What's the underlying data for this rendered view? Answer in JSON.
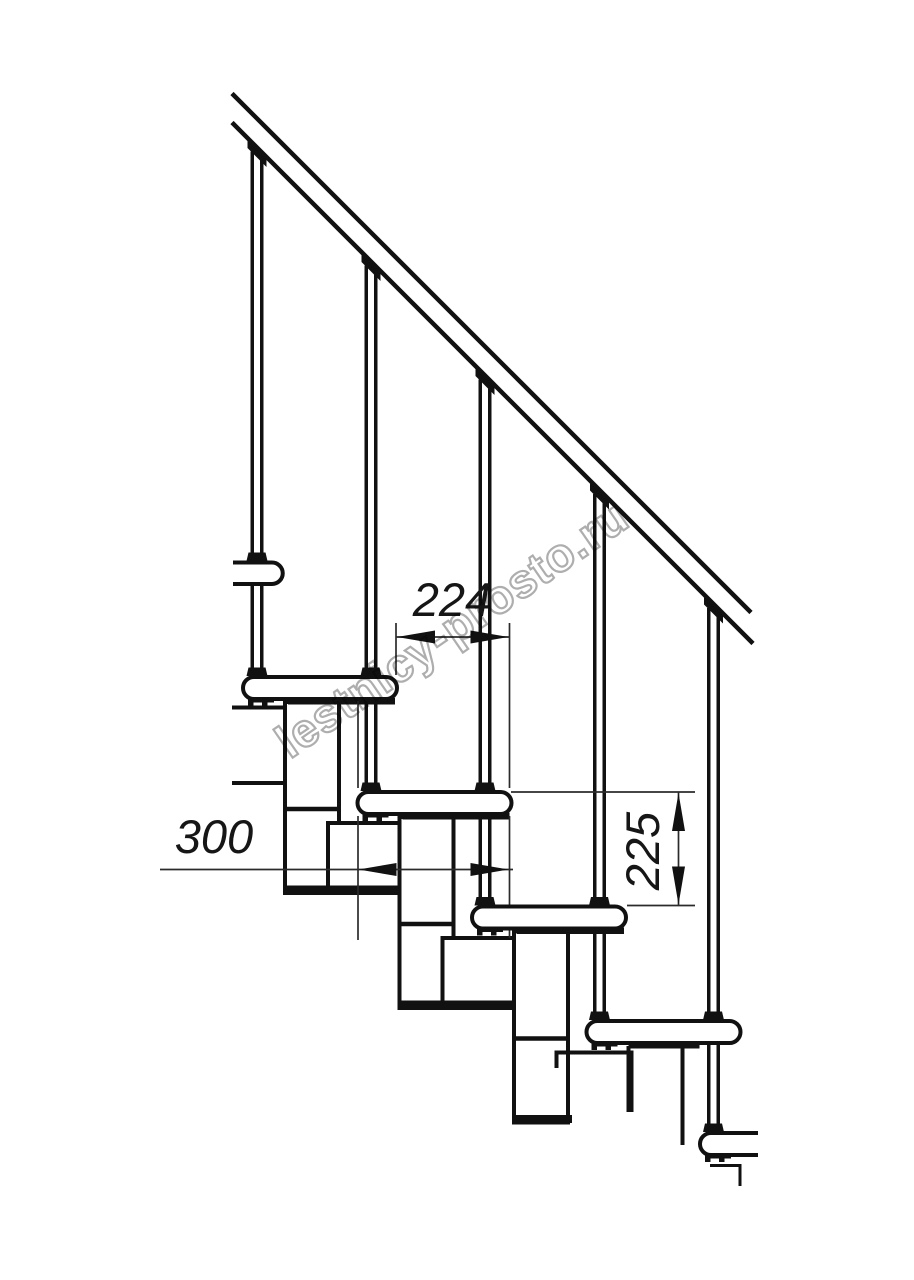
{
  "watermark": {
    "text": "lestnicy-prosto.ru"
  },
  "dimensions": {
    "going_mm": "224",
    "tread_depth_mm": "300",
    "rise_mm": "225"
  },
  "diagram": {
    "canvas": {
      "width": 914,
      "height": 1280,
      "background": "#ffffff"
    },
    "style": {
      "line": "#111111",
      "thin": "#2b2b2b",
      "fill": "#ffffff"
    },
    "shapes": [
      {
        "t": "line",
        "name": "upper-floor-edge-line",
        "x1": 232,
        "y1": 707.5,
        "x2": 287,
        "y2": 707.5,
        "w": 4
      },
      {
        "t": "line",
        "name": "upper-floor-edge-line",
        "x1": 232,
        "y1": 783,
        "x2": 287,
        "y2": 783,
        "w": 4
      },
      {
        "t": "line",
        "name": "baluster-1-left-line",
        "x1": 252.25,
        "y1": 151.5,
        "x2": 252.25,
        "y2": 676,
        "w": 3.5
      },
      {
        "t": "line",
        "name": "baluster-1-right-line",
        "x1": 261.75,
        "y1": 151.5,
        "x2": 261.75,
        "y2": 676,
        "w": 3.5
      },
      {
        "t": "line",
        "name": "baluster-2-left-line",
        "x1": 366.25,
        "y1": 265.5,
        "x2": 366.25,
        "y2": 791,
        "w": 3.5
      },
      {
        "t": "line",
        "name": "baluster-2-right-line",
        "x1": 375.75,
        "y1": 265.5,
        "x2": 375.75,
        "y2": 791,
        "w": 3.5
      },
      {
        "t": "line",
        "name": "baluster-3-left-line",
        "x1": 480.25,
        "y1": 379.5,
        "x2": 480.25,
        "y2": 905,
        "w": 3.5
      },
      {
        "t": "line",
        "name": "baluster-3-right-line",
        "x1": 489.75,
        "y1": 379.5,
        "x2": 489.75,
        "y2": 905,
        "w": 3.5
      },
      {
        "t": "line",
        "name": "baluster-4-left-line",
        "x1": 594.75,
        "y1": 494,
        "x2": 594.75,
        "y2": 1020,
        "w": 3.5
      },
      {
        "t": "line",
        "name": "baluster-4-right-line",
        "x1": 604.25,
        "y1": 494,
        "x2": 604.25,
        "y2": 1020,
        "w": 3.5
      },
      {
        "t": "line",
        "name": "baluster-5-left-line",
        "x1": 708.75,
        "y1": 608,
        "x2": 708.75,
        "y2": 1132,
        "w": 3.5
      },
      {
        "t": "line",
        "name": "baluster-5-right-line",
        "x1": 718.25,
        "y1": 608,
        "x2": 718.25,
        "y2": 1132,
        "w": 3.5
      },
      {
        "t": "poly",
        "name": "rail-connector",
        "pts": "247.5,139 266.5,158 266.5,167 247.5,148"
      },
      {
        "t": "poly",
        "name": "rail-connector",
        "pts": "361.5,253 380.5,272 380.5,281 361.5,262"
      },
      {
        "t": "poly",
        "name": "rail-connector",
        "pts": "475.5,367 494.5,386 494.5,395 475.5,376"
      },
      {
        "t": "poly",
        "name": "rail-connector",
        "pts": "590,481.5 609,500.5 609,509.5 590,490.5"
      },
      {
        "t": "poly",
        "name": "rail-connector",
        "pts": "704,595.5 723,614.5 723,623.5 704,604.5"
      },
      {
        "t": "rect",
        "name": "module-stem",
        "x": 285,
        "y": 702,
        "wd": 54,
        "h": 191,
        "sw": 4
      },
      {
        "t": "rect",
        "name": "module-box",
        "x": 328,
        "y": 823,
        "wd": 75,
        "h": 70,
        "sw": 4
      },
      {
        "t": "line",
        "name": "module-joint-line",
        "x1": 285,
        "y1": 809,
        "x2": 339,
        "y2": 809,
        "w": 4.5
      },
      {
        "t": "rect",
        "name": "module-base-plate",
        "x": 283,
        "y": 885.5,
        "wd": 122,
        "h": 8,
        "f": "#111111",
        "sw": 0
      },
      {
        "t": "rect",
        "name": "tread-mount-plate",
        "x": 288,
        "y": 698,
        "wd": 107,
        "h": 6.5,
        "f": "#111111",
        "sw": 0
      },
      {
        "t": "path",
        "name": "tread-bracket",
        "d": "M248,698 h26 v4.5 h-6.5 v3.5 h-5.5 v-3.5 h-8.5 v3.5 h-5.5 z",
        "f": "#111111",
        "sw": 0
      },
      {
        "t": "rect",
        "name": "module-stem",
        "x": 399.5,
        "y": 817,
        "wd": 54,
        "h": 191,
        "sw": 4
      },
      {
        "t": "rect",
        "name": "module-box",
        "x": 442.5,
        "y": 938,
        "wd": 75,
        "h": 70,
        "sw": 4
      },
      {
        "t": "line",
        "name": "module-joint-line",
        "x1": 399.5,
        "y1": 924,
        "x2": 453.5,
        "y2": 924,
        "w": 4.5
      },
      {
        "t": "rect",
        "name": "module-base-plate",
        "x": 397.5,
        "y": 1000.5,
        "wd": 122,
        "h": 8,
        "f": "#111111",
        "sw": 0
      },
      {
        "t": "rect",
        "name": "tread-mount-plate",
        "x": 402.5,
        "y": 813,
        "wd": 107,
        "h": 6.5,
        "f": "#111111",
        "sw": 0
      },
      {
        "t": "path",
        "name": "tread-bracket",
        "d": "M362.5,813 h26 v4.5 h-6.5 v3.5 h-5.5 v-3.5 h-8.5 v3.5 h-5.5 z",
        "f": "#111111",
        "sw": 0
      },
      {
        "t": "rect",
        "name": "module-stem",
        "x": 514,
        "y": 931.5,
        "wd": 54,
        "h": 191,
        "sw": 4
      },
      {
        "t": "path",
        "name": "module-box-partial",
        "d": "M556.5,1068 L556.5,1052.5 L631.5,1052.5 L631.5,1112",
        "f": "none",
        "sw": 4
      },
      {
        "t": "line",
        "name": "module-joint-line",
        "x1": 514,
        "y1": 1038.5,
        "x2": 568,
        "y2": 1038.5,
        "w": 4.5
      },
      {
        "t": "rect",
        "name": "module-base-plate",
        "x": 512,
        "y": 1115,
        "wd": 60,
        "h": 8,
        "f": "#111111",
        "sw": 0
      },
      {
        "t": "rect",
        "name": "tread-mount-plate",
        "x": 517,
        "y": 927.5,
        "wd": 107,
        "h": 6.5,
        "f": "#111111",
        "sw": 0
      },
      {
        "t": "path",
        "name": "tread-bracket",
        "d": "M477,927.5 h26 v4.5 h-6.5 v3.5 h-5.5 v-3.5 h-8.5 v3.5 h-5.5 z",
        "f": "#111111",
        "sw": 0
      },
      {
        "t": "line",
        "name": "module-stem-partial-edge",
        "x1": 628.5,
        "y1": 1046,
        "x2": 628.5,
        "y2": 1112,
        "w": 4
      },
      {
        "t": "line",
        "name": "module-stem-partial-edge",
        "x1": 682.5,
        "y1": 1046,
        "x2": 682.5,
        "y2": 1145,
        "w": 4
      },
      {
        "t": "rect",
        "name": "tread-mount-plate",
        "x": 628.5,
        "y": 1042,
        "wd": 71,
        "h": 6.5,
        "f": "#111111",
        "sw": 0
      },
      {
        "t": "path",
        "name": "tread-bracket",
        "d": "M591.5,1042 h26 v4.5 h-6.5 v3.5 h-5.5 v-3.5 h-8.5 v3.5 h-5.5 z",
        "f": "#111111",
        "sw": 0
      },
      {
        "t": "line",
        "name": "extension-line",
        "x1": 396,
        "y1": 623,
        "x2": 396,
        "y2": 675,
        "w": 1.7,
        "c": "#2b2b2b"
      },
      {
        "t": "line",
        "name": "extension-line",
        "x1": 509.5,
        "y1": 623,
        "x2": 509.5,
        "y2": 788,
        "w": 1.7,
        "c": "#2b2b2b"
      },
      {
        "t": "line",
        "name": "extension-line",
        "x1": 509.5,
        "y1": 816,
        "x2": 509.5,
        "y2": 938,
        "w": 1.7,
        "c": "#2b2b2b"
      },
      {
        "t": "line",
        "name": "extension-line",
        "x1": 358,
        "y1": 700,
        "x2": 358,
        "y2": 788,
        "w": 1.7,
        "c": "#2b2b2b"
      },
      {
        "t": "line",
        "name": "extension-line",
        "x1": 358,
        "y1": 816,
        "x2": 358,
        "y2": 940,
        "w": 1.7,
        "c": "#2b2b2b"
      },
      {
        "t": "line",
        "name": "extension-line",
        "x1": 511,
        "y1": 792,
        "x2": 695,
        "y2": 792,
        "w": 1.7,
        "c": "#2b2b2b"
      },
      {
        "t": "line",
        "name": "extension-line",
        "x1": 627,
        "y1": 905.5,
        "x2": 695,
        "y2": 905.5,
        "w": 1.7,
        "c": "#2b2b2b"
      },
      {
        "t": "line",
        "name": "dimension-line-going",
        "x1": 396,
        "y1": 637,
        "x2": 509.5,
        "y2": 637,
        "w": 1.7,
        "c": "#2b2b2b"
      },
      {
        "t": "line",
        "name": "dimension-line-tread-depth",
        "x1": 160,
        "y1": 869.5,
        "x2": 513,
        "y2": 869.5,
        "w": 1.7,
        "c": "#2b2b2b"
      },
      {
        "t": "line",
        "name": "dimension-line-rise",
        "x1": 678.5,
        "y1": 792,
        "x2": 678.5,
        "y2": 905.5,
        "w": 1.7,
        "c": "#2b2b2b"
      },
      {
        "t": "path",
        "name": "tread-fragment-upper",
        "d": "M233,562.5 H272 A10.75,10.75 0 0 1 272,584 H233",
        "f": "#ffffff",
        "sw": 4
      },
      {
        "t": "rect",
        "name": "tread",
        "x": 243,
        "y": 677,
        "wd": 154,
        "h": 22,
        "rx": 11,
        "sw": 4
      },
      {
        "t": "rect",
        "name": "tread",
        "x": 357.5,
        "y": 792,
        "wd": 154,
        "h": 22,
        "rx": 11,
        "sw": 4
      },
      {
        "t": "rect",
        "name": "tread",
        "x": 472,
        "y": 906.5,
        "wd": 154,
        "h": 22,
        "rx": 11,
        "sw": 4
      },
      {
        "t": "rect",
        "name": "tread",
        "x": 586.5,
        "y": 1021,
        "wd": 154,
        "h": 22,
        "rx": 11,
        "sw": 4
      },
      {
        "t": "path",
        "name": "tread-fragment-lower",
        "d": "M758,1155 H711 A11,11 0 0 1 711,1133 H758",
        "f": "#ffffff",
        "sw": 4
      },
      {
        "t": "poly",
        "name": "baluster-clamp",
        "pts": "246.5,561 248.5,552.5 265.5,552.5 267.5,561"
      },
      {
        "t": "poly",
        "name": "baluster-clamp",
        "pts": "360.5,676 362.5,667.5 379.5,667.5 381.5,676"
      },
      {
        "t": "poly",
        "name": "baluster-clamp",
        "pts": "474.5,791 476.5,782.5 493.5,782.5 495.5,791"
      },
      {
        "t": "poly",
        "name": "baluster-clamp",
        "pts": "589,905.5 591,897 608,897 610,905.5"
      },
      {
        "t": "poly",
        "name": "baluster-clamp",
        "pts": "703,1020 705,1011.5 722,1011.5 724,1020"
      },
      {
        "t": "poly",
        "name": "baluster-foot",
        "pts": "246.5,676 248.5,667.5 265.5,667.5 267.5,676"
      },
      {
        "t": "poly",
        "name": "baluster-foot",
        "pts": "360.5,791 362.5,782.5 379.5,782.5 381.5,791"
      },
      {
        "t": "poly",
        "name": "baluster-foot",
        "pts": "474.5,905.5 476.5,897 493.5,897 495.5,905.5"
      },
      {
        "t": "poly",
        "name": "baluster-foot",
        "pts": "589,1020 591,1011.5 608,1011.5 610,1020"
      },
      {
        "t": "poly",
        "name": "baluster-foot",
        "pts": "703,1132 705,1123.5 722,1123.5 724,1132"
      },
      {
        "t": "path",
        "name": "tread-bracket",
        "d": "M705,1154 h26 v4.5 h-6.5 v3.5 h-5.5 v-3.5 h-8.5 v3.5 h-5.5 z",
        "f": "#111111",
        "sw": 0
      },
      {
        "t": "path",
        "name": "module-step-partial-edge",
        "d": "M710,1165.5 H740 V1186",
        "f": "none",
        "sw": 3
      },
      {
        "t": "line",
        "name": "handrail-upper-line",
        "x1": 232,
        "y1": 93.5,
        "x2": 751,
        "y2": 612.5,
        "w": 4.5
      },
      {
        "t": "line",
        "name": "handrail-lower-line",
        "x1": 232,
        "y1": 122.5,
        "x2": 753,
        "y2": 643.5,
        "w": 4.5
      },
      {
        "t": "poly",
        "name": "dimension-arrow-left",
        "pts": "397,637 435,630.5 435,643.5"
      },
      {
        "t": "poly",
        "name": "dimension-arrow-right",
        "pts": "508.5,637 470.5,630.5 470.5,643.5"
      },
      {
        "t": "poly",
        "name": "dimension-arrow-left",
        "pts": "358.5,869.5 396.5,863 396.5,876"
      },
      {
        "t": "poly",
        "name": "dimension-arrow-right",
        "pts": "508.5,869.5 470.5,863 470.5,876"
      },
      {
        "t": "poly",
        "name": "dimension-arrow-up",
        "pts": "678.5,793 672,831 685,831"
      },
      {
        "t": "poly",
        "name": "dimension-arrow-down",
        "pts": "678.5,904.5 672,866.5 685,866.5"
      },
      {
        "t": "text",
        "name": "dim-label-going",
        "x": 452,
        "y": 616,
        "cls": "dim",
        "bind": "dimensions.going_mm"
      },
      {
        "t": "text",
        "name": "dim-label-tread-depth",
        "x": 214,
        "y": 853,
        "cls": "dim",
        "bind": "dimensions.tread_depth_mm"
      },
      {
        "t": "text",
        "name": "dim-label-rise",
        "x": 659,
        "y": 851,
        "tr": "rotate(-90 659 851)",
        "cls": "dim",
        "bind": "dimensions.rise_mm"
      },
      {
        "t": "text",
        "name": "watermark-text",
        "x": 461,
        "y": 642,
        "tr": "rotate(-34.5 461 642)",
        "cls": "wm",
        "bind": "watermark.text"
      }
    ]
  }
}
